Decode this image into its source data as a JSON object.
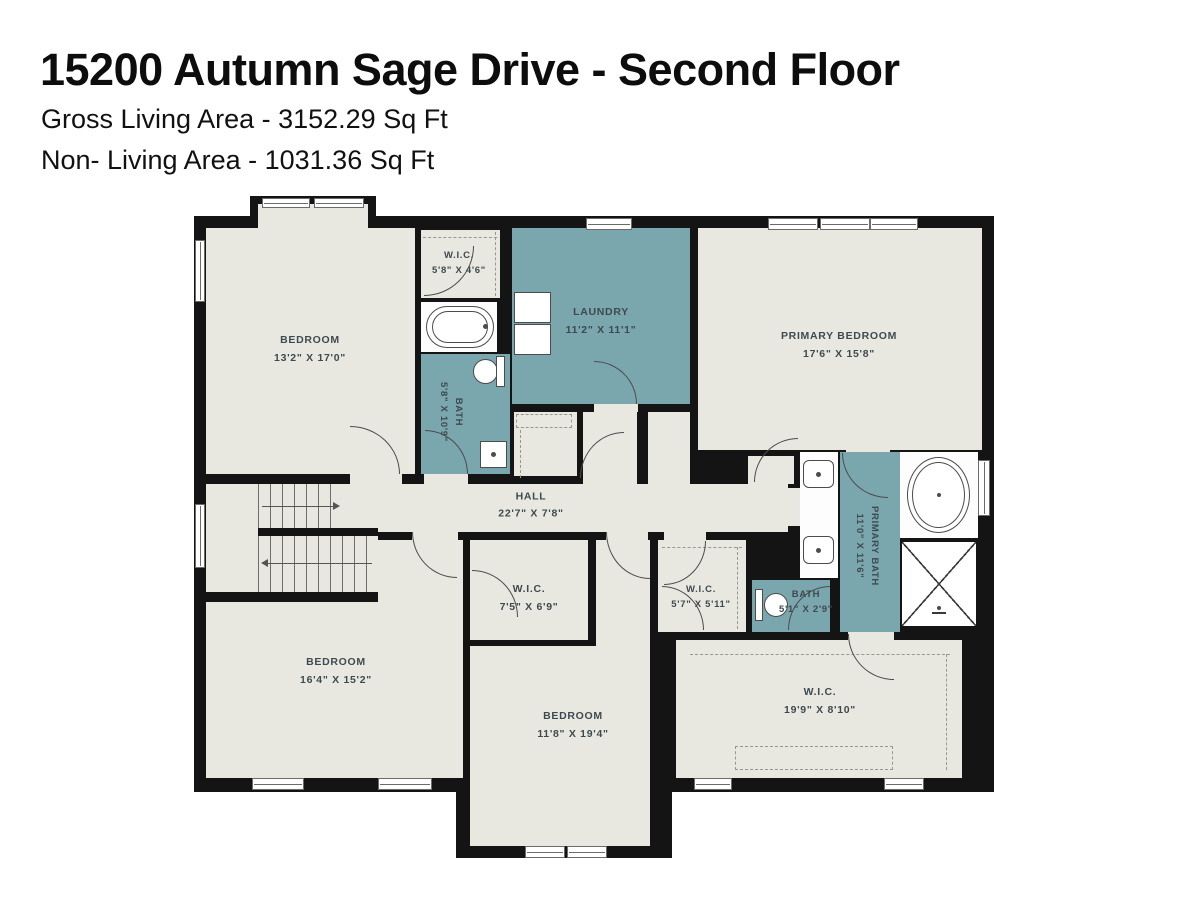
{
  "header": {
    "title": "15200 Autumn Sage Drive - Second Floor",
    "gross_living_area": "Gross Living Area - 3152.29 Sq Ft",
    "non_living_area": "Non- Living Area - 1031.36 Sq Ft"
  },
  "colors": {
    "floor": "#e9e8e0",
    "wet_room": "#7aa6ad",
    "wall": "#141414",
    "label_text": "#3d4a50",
    "background": "#ffffff"
  },
  "rooms": [
    {
      "id": "bedroom-top-left",
      "name": "BEDROOM",
      "dims": "13'2\" X 17'0\""
    },
    {
      "id": "wic-top",
      "name": "W.I.C.",
      "dims": "5'8\" X 4'6\""
    },
    {
      "id": "bath-top",
      "name": "BATH",
      "dims": "5'8\" X 10'9\""
    },
    {
      "id": "laundry",
      "name": "LAUNDRY",
      "dims": "11'2\" X 11'1\""
    },
    {
      "id": "primary-bedroom",
      "name": "PRIMARY BEDROOM",
      "dims": "17'6\" X 15'8\""
    },
    {
      "id": "hall",
      "name": "HALL",
      "dims": "22'7\" X 7'8\""
    },
    {
      "id": "primary-bath",
      "name": "PRIMARY BATH",
      "dims": "11'0\" X 11'6\""
    },
    {
      "id": "wic-middle",
      "name": "W.I.C.",
      "dims": "7'5\" X 6'9\""
    },
    {
      "id": "wic-small",
      "name": "W.I.C.",
      "dims": "5'7\" X 5'11\""
    },
    {
      "id": "bath-small",
      "name": "BATH",
      "dims": "5'1\" X 2'9\""
    },
    {
      "id": "bedroom-bottom-left",
      "name": "BEDROOM",
      "dims": "16'4\" X 15'2\""
    },
    {
      "id": "bedroom-bottom-mid",
      "name": "BEDROOM",
      "dims": "11'8\" X 19'4\""
    },
    {
      "id": "wic-bottom-right",
      "name": "W.I.C.",
      "dims": "19'9\" X 8'10\""
    }
  ],
  "fixtures": [
    "bathtub",
    "toilet",
    "sink",
    "washer",
    "dryer",
    "vanity-sinks",
    "oval-tub",
    "shower",
    "stairs"
  ]
}
